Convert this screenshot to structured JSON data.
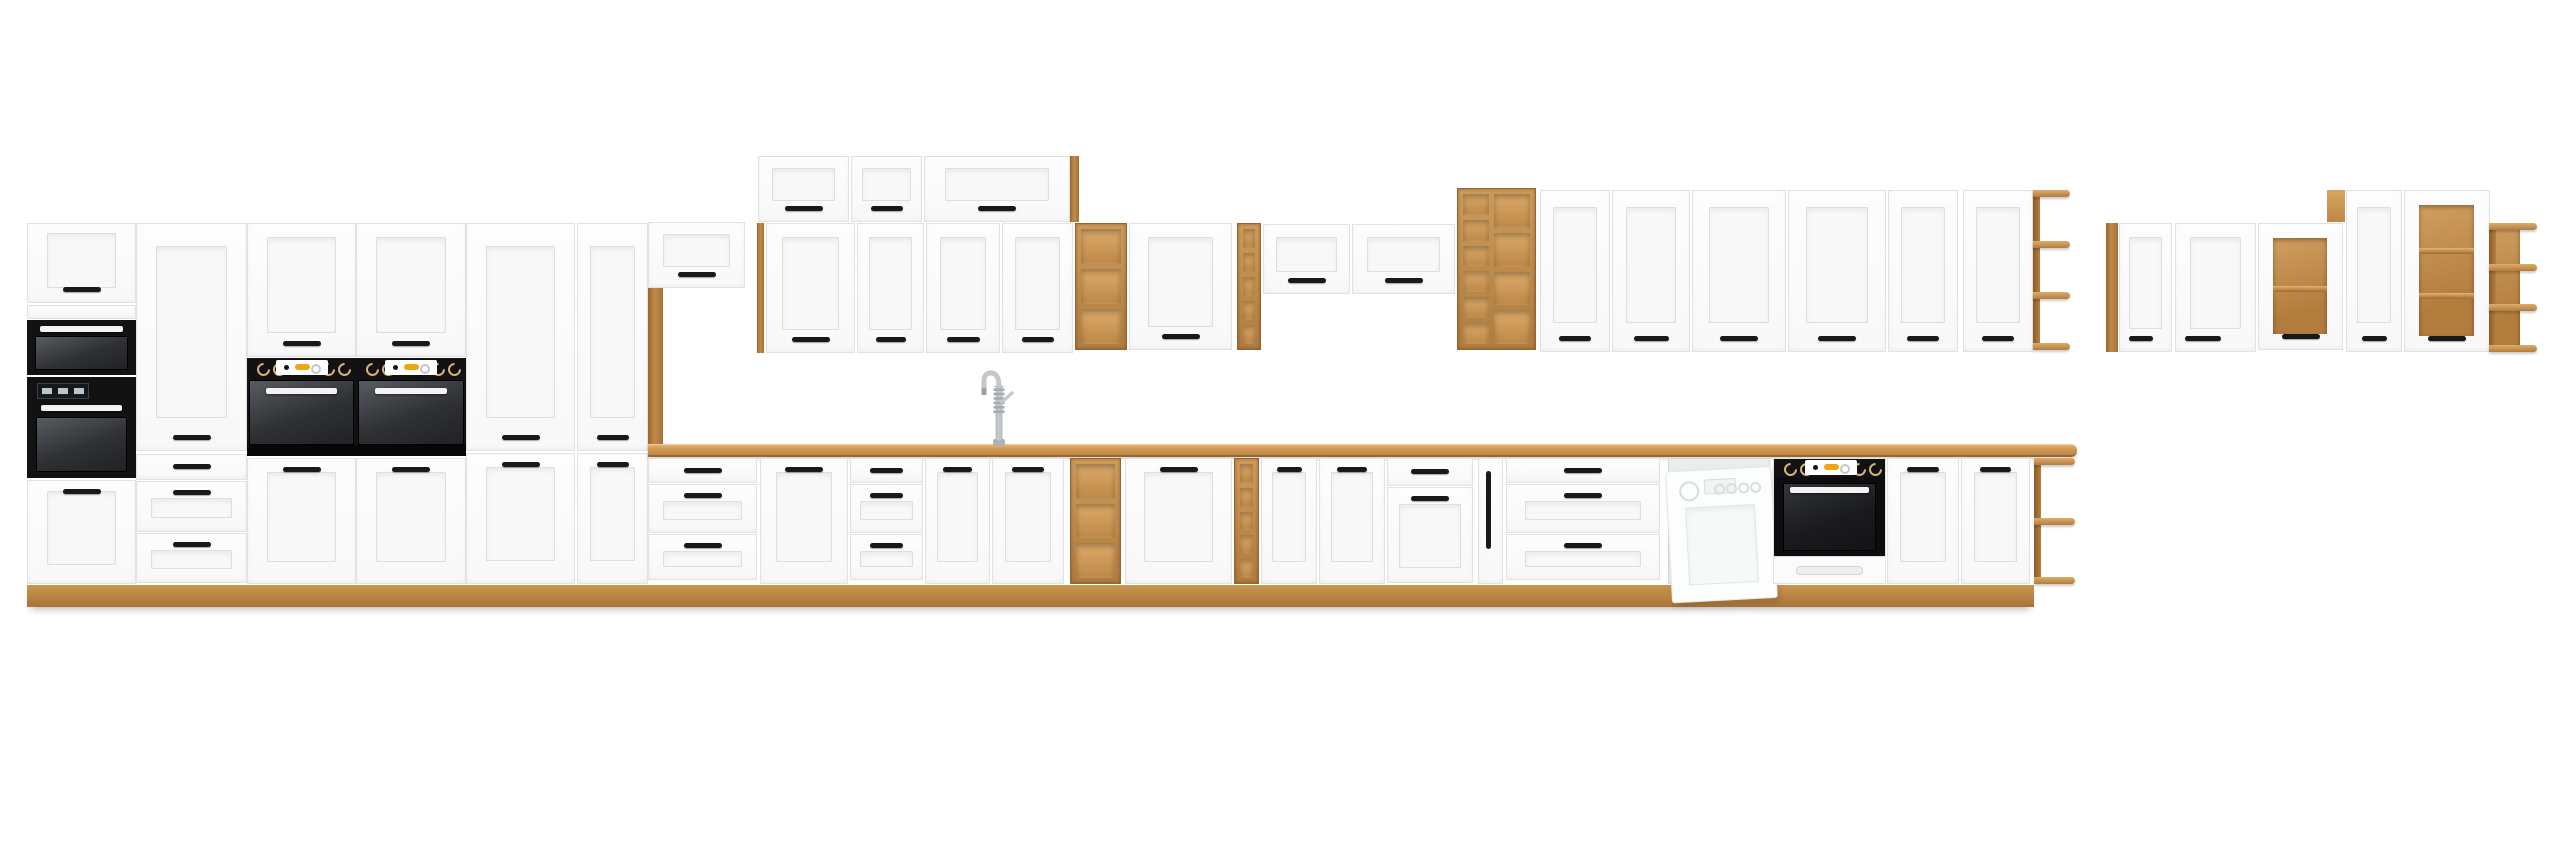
{
  "meta": {
    "title": "White and oak modular kitchen cabinet set product render",
    "background": "#ffffff"
  },
  "scene": {
    "canvas": {
      "w": 2560,
      "h": 848
    },
    "palette": {
      "white_front": "#fcfcfc",
      "front_line": "#e2e2e2",
      "panel": "#f7f7f7",
      "oak": "#c28a4a",
      "oak_light": "#dcaa68",
      "oak_dark": "#96662f",
      "worktop": "#cf9855",
      "handle_black": "#191919",
      "appliance_black": "#121212",
      "appliance_glass": "#3a3d41",
      "display_orange": "#f2a60d",
      "steel": "#c3c9cb",
      "dishwasher_white": "#fcfdfd"
    },
    "modules": [
      {
        "id": "plinth-strip",
        "type": "plinth",
        "x": 27,
        "y": 585,
        "w": 2007,
        "h": 22
      },
      {
        "id": "tall-a1-top-door",
        "type": "door",
        "x": 27,
        "y": 223,
        "w": 109,
        "h": 80,
        "o": {
          "hp": "bottom"
        }
      },
      {
        "id": "tall-a1-fixed-strip",
        "type": "panel",
        "x": 27,
        "y": 305,
        "w": 109,
        "h": 14
      },
      {
        "id": "tall-a1-microwave",
        "type": "micro",
        "x": 27,
        "y": 320,
        "w": 109,
        "h": 55
      },
      {
        "id": "tall-a1-oven",
        "type": "ovenA1",
        "x": 27,
        "y": 377,
        "w": 109,
        "h": 101
      },
      {
        "id": "tall-a1-bottom-door",
        "type": "door",
        "x": 27,
        "y": 480,
        "w": 109,
        "h": 104,
        "o": {
          "hp": "top"
        }
      },
      {
        "id": "tall-a2-door",
        "type": "door",
        "x": 136,
        "y": 223,
        "w": 111,
        "h": 228,
        "o": {
          "hp": "bottom"
        }
      },
      {
        "id": "tall-a2-drawers",
        "type": "drawers",
        "x": 136,
        "y": 454,
        "w": 111,
        "h": 130,
        "o": {
          "rows": [
            {
              "h": 24,
              "hp": "mid"
            },
            {
              "h": 49,
              "f": 1,
              "hp": "top"
            },
            {
              "h": 48,
              "f": 1,
              "hp": "top"
            }
          ]
        }
      },
      {
        "id": "tall-a3-door",
        "type": "door",
        "x": 247,
        "y": 223,
        "w": 109,
        "h": 134,
        "o": {
          "hp": "bottom"
        }
      },
      {
        "id": "tall-a3-oven",
        "type": "ovenTall",
        "x": 247,
        "y": 358,
        "w": 109,
        "h": 98
      },
      {
        "id": "tall-a3-bottom-door",
        "type": "door",
        "x": 247,
        "y": 458,
        "w": 109,
        "h": 126,
        "o": {
          "hp": "top"
        }
      },
      {
        "id": "tall-a4-door",
        "type": "door",
        "x": 356,
        "y": 223,
        "w": 110,
        "h": 134,
        "o": {
          "hp": "bottom"
        }
      },
      {
        "id": "tall-a4-oven",
        "type": "ovenTall",
        "x": 356,
        "y": 358,
        "w": 110,
        "h": 98
      },
      {
        "id": "tall-a4-bottom-door",
        "type": "door",
        "x": 356,
        "y": 458,
        "w": 110,
        "h": 126,
        "o": {
          "hp": "top"
        }
      },
      {
        "id": "tall-a5-door",
        "type": "door",
        "x": 466,
        "y": 223,
        "w": 109,
        "h": 228,
        "o": {
          "hp": "bottom"
        }
      },
      {
        "id": "tall-a5-bottom-door",
        "type": "door",
        "x": 466,
        "y": 453,
        "w": 109,
        "h": 131,
        "o": {
          "hp": "top"
        }
      },
      {
        "id": "pantry-door",
        "type": "door",
        "x": 577,
        "y": 223,
        "w": 71,
        "h": 228,
        "o": {
          "hp": "bottom"
        }
      },
      {
        "id": "pantry-bottom-door",
        "type": "door",
        "x": 577,
        "y": 453,
        "w": 71,
        "h": 131,
        "o": {
          "hp": "top"
        }
      },
      {
        "id": "niche-bridge-cabinet",
        "type": "hdoor",
        "x": 648,
        "y": 222,
        "w": 97,
        "h": 66,
        "o": {
          "hp": "bottom"
        }
      },
      {
        "id": "niche-oak-pillar",
        "type": "oak",
        "x": 648,
        "y": 288,
        "w": 15,
        "h": 156
      },
      {
        "id": "wall-oak-side",
        "type": "oak",
        "x": 757,
        "y": 223,
        "w": 7,
        "h": 130
      },
      {
        "id": "upper-cab-1",
        "type": "hdoor",
        "x": 758,
        "y": 156,
        "w": 91,
        "h": 66,
        "o": {
          "hp": "bottom"
        }
      },
      {
        "id": "upper-cab-2",
        "type": "hdoor",
        "x": 851,
        "y": 156,
        "w": 71,
        "h": 66,
        "o": {
          "hp": "bottom"
        }
      },
      {
        "id": "upper-cab-3",
        "type": "hdoor",
        "x": 924,
        "y": 156,
        "w": 146,
        "h": 66,
        "o": {
          "hp": "bottom"
        }
      },
      {
        "id": "upper-oak-panel",
        "type": "oak",
        "x": 1070,
        "y": 156,
        "w": 9,
        "h": 66
      },
      {
        "id": "wall-door-1",
        "type": "door",
        "x": 766,
        "y": 223,
        "w": 89,
        "h": 130,
        "o": {
          "hp": "bottom"
        }
      },
      {
        "id": "wall-door-2",
        "type": "door",
        "x": 857,
        "y": 223,
        "w": 67,
        "h": 130,
        "o": {
          "hp": "bottom"
        }
      },
      {
        "id": "wall-door-3",
        "type": "door",
        "x": 926,
        "y": 223,
        "w": 74,
        "h": 130,
        "o": {
          "hp": "bottom"
        }
      },
      {
        "id": "wall-door-4",
        "type": "door",
        "x": 1002,
        "y": 223,
        "w": 71,
        "h": 130,
        "o": {
          "hp": "bottom"
        }
      },
      {
        "id": "wall-open-shelf-1",
        "type": "cub",
        "x": 1075,
        "y": 223,
        "w": 52,
        "h": 127,
        "o": {
          "cols": [
            {
              "rows": 3
            }
          ]
        }
      },
      {
        "id": "wall-door-5",
        "type": "door",
        "x": 1129,
        "y": 223,
        "w": 103,
        "h": 127,
        "o": {
          "hp": "bottom"
        }
      },
      {
        "id": "wall-rack-1",
        "type": "cub",
        "x": 1237,
        "y": 223,
        "w": 24,
        "h": 127,
        "o": {
          "cols": [
            {
              "rows": 5
            }
          ]
        }
      },
      {
        "id": "wall-hcab-1",
        "type": "hdoor",
        "x": 1263,
        "y": 224,
        "w": 87,
        "h": 70,
        "o": {
          "hp": "bottom"
        }
      },
      {
        "id": "wall-hcab-2",
        "type": "hdoor",
        "x": 1352,
        "y": 224,
        "w": 103,
        "h": 70,
        "o": {
          "hp": "bottom"
        }
      },
      {
        "id": "wall-open-shelf-2",
        "type": "cub",
        "x": 1457,
        "y": 188,
        "w": 79,
        "h": 162,
        "o": {
          "cols": [
            {
              "w": 26,
              "rows": 6
            },
            {
              "rows": 4
            }
          ]
        }
      },
      {
        "id": "wall-door-6",
        "type": "door",
        "x": 1540,
        "y": 190,
        "w": 70,
        "h": 162,
        "o": {
          "hp": "bottom"
        }
      },
      {
        "id": "wall-door-7",
        "type": "door",
        "x": 1612,
        "y": 190,
        "w": 78,
        "h": 162,
        "o": {
          "hp": "bottom"
        }
      },
      {
        "id": "wall-door-8",
        "type": "door",
        "x": 1692,
        "y": 190,
        "w": 94,
        "h": 162,
        "o": {
          "hp": "bottom"
        }
      },
      {
        "id": "wall-door-9",
        "type": "door",
        "x": 1788,
        "y": 190,
        "w": 98,
        "h": 162,
        "o": {
          "hp": "bottom"
        }
      },
      {
        "id": "wall-door-10",
        "type": "door",
        "x": 1888,
        "y": 190,
        "w": 70,
        "h": 162,
        "o": {
          "hp": "bottom"
        }
      },
      {
        "id": "wall-door-11",
        "type": "door",
        "x": 1963,
        "y": 190,
        "w": 70,
        "h": 162,
        "o": {
          "hp": "bottom"
        }
      },
      {
        "id": "wall-corner-shelf",
        "type": "sideshelf",
        "x": 2033,
        "y": 190,
        "w": 37,
        "h": 160,
        "o": {
          "boards": 4
        }
      },
      {
        "id": "fr-oak-panel",
        "type": "oak",
        "x": 2106,
        "y": 223,
        "w": 12,
        "h": 129
      },
      {
        "id": "fr-door-1",
        "type": "door",
        "x": 2119,
        "y": 223,
        "w": 53,
        "h": 129,
        "o": {
          "hp": "bottom",
          "ha": "left"
        }
      },
      {
        "id": "fr-door-2",
        "type": "door",
        "x": 2175,
        "y": 223,
        "w": 81,
        "h": 129,
        "o": {
          "hp": "bottom",
          "ha": "left"
        }
      },
      {
        "id": "fr-glass-cab-1",
        "type": "glass",
        "x": 2258,
        "y": 223,
        "w": 85,
        "h": 127,
        "o": {
          "shelves": 1
        }
      },
      {
        "id": "fr-oak-filler",
        "type": "oakface",
        "x": 2327,
        "y": 190,
        "w": 18,
        "h": 32
      },
      {
        "id": "fr-door-3",
        "type": "door",
        "x": 2346,
        "y": 190,
        "w": 56,
        "h": 162,
        "o": {
          "hp": "bottom"
        }
      },
      {
        "id": "fr-glass-cab-2",
        "type": "glass",
        "x": 2404,
        "y": 190,
        "w": 86,
        "h": 162,
        "o": {
          "shelves": 2
        }
      },
      {
        "id": "fr-corner-shelf",
        "type": "sideshelf",
        "x": 2489,
        "y": 223,
        "w": 48,
        "h": 129,
        "o": {
          "boards": 4,
          "back": 31
        }
      },
      {
        "id": "worktop",
        "type": "worktop",
        "x": 648,
        "y": 444,
        "w": 1429,
        "h": 13
      },
      {
        "id": "sink-basin",
        "type": "sink",
        "x": 930,
        "y": 441,
        "w": 136,
        "h": 14
      },
      {
        "id": "sink-faucet",
        "type": "faucet",
        "x": 979,
        "y": 356,
        "w": 40,
        "h": 90
      },
      {
        "id": "base-drawers-1",
        "type": "drawers",
        "x": 648,
        "y": 458,
        "w": 109,
        "h": 126,
        "o": {
          "rows": [
            {
              "h": 23,
              "hp": "mid"
            },
            {
              "h": 47,
              "f": 1,
              "hp": "top"
            },
            {
              "h": 44,
              "f": 1,
              "hp": "top"
            }
          ]
        }
      },
      {
        "id": "base-door-1",
        "type": "door",
        "x": 760,
        "y": 458,
        "w": 88,
        "h": 126,
        "o": {
          "hp": "top"
        }
      },
      {
        "id": "base-drawers-2",
        "type": "drawers",
        "x": 850,
        "y": 458,
        "w": 73,
        "h": 126,
        "o": {
          "rows": [
            {
              "h": 23,
              "hp": "mid"
            },
            {
              "h": 47,
              "f": 1,
              "hp": "top"
            },
            {
              "h": 44,
              "f": 1,
              "hp": "top"
            }
          ]
        }
      },
      {
        "id": "sink-door-left",
        "type": "door",
        "x": 925,
        "y": 458,
        "w": 65,
        "h": 126,
        "o": {
          "hp": "top"
        }
      },
      {
        "id": "sink-door-right",
        "type": "door",
        "x": 992,
        "y": 458,
        "w": 72,
        "h": 126,
        "o": {
          "hp": "top"
        }
      },
      {
        "id": "base-open-shelf-1",
        "type": "cub",
        "x": 1070,
        "y": 458,
        "w": 51,
        "h": 126,
        "o": {
          "cols": [
            {
              "rows": 3
            }
          ]
        }
      },
      {
        "id": "base-door-2",
        "type": "door",
        "x": 1125,
        "y": 458,
        "w": 107,
        "h": 126,
        "o": {
          "hp": "top"
        }
      },
      {
        "id": "base-rack-1",
        "type": "cub",
        "x": 1234,
        "y": 458,
        "w": 25,
        "h": 126,
        "o": {
          "cols": [
            {
              "rows": 5
            }
          ]
        }
      },
      {
        "id": "base-door-3",
        "type": "door",
        "x": 1261,
        "y": 458,
        "w": 56,
        "h": 126,
        "o": {
          "hp": "top"
        }
      },
      {
        "id": "base-door-4",
        "type": "door",
        "x": 1319,
        "y": 458,
        "w": 66,
        "h": 126,
        "o": {
          "hp": "top"
        }
      },
      {
        "id": "base-drawer-door",
        "type": "drawers",
        "x": 1387,
        "y": 458,
        "w": 86,
        "h": 126,
        "o": {
          "rows": [
            {
              "h": 26,
              "hp": "mid"
            },
            {
              "h": 94,
              "f": 1,
              "hp": "top"
            }
          ]
        }
      },
      {
        "id": "base-cargo-pullout",
        "type": "pullout",
        "x": 1478,
        "y": 458,
        "w": 25,
        "h": 126
      },
      {
        "id": "base-drawers-3",
        "type": "drawers",
        "x": 1506,
        "y": 458,
        "w": 154,
        "h": 126,
        "o": {
          "rows": [
            {
              "h": 23,
              "hp": "mid"
            },
            {
              "h": 47,
              "f": 1,
              "hp": "top"
            },
            {
              "h": 44,
              "f": 1,
              "hp": "top"
            }
          ]
        }
      },
      {
        "id": "dishwasher",
        "type": "dw",
        "x": 1668,
        "y": 458,
        "w": 102,
        "h": 126
      },
      {
        "id": "base-oven",
        "type": "ovenBase",
        "x": 1773,
        "y": 458,
        "w": 113,
        "h": 126
      },
      {
        "id": "base-door-5",
        "type": "door",
        "x": 1887,
        "y": 458,
        "w": 72,
        "h": 126,
        "o": {
          "hp": "top"
        }
      },
      {
        "id": "base-door-6",
        "type": "door",
        "x": 1961,
        "y": 458,
        "w": 69,
        "h": 126,
        "o": {
          "hp": "top"
        }
      },
      {
        "id": "base-corner-shelf",
        "type": "sideshelf",
        "x": 2034,
        "y": 458,
        "w": 41,
        "h": 126,
        "o": {
          "boards": 3
        }
      }
    ]
  }
}
